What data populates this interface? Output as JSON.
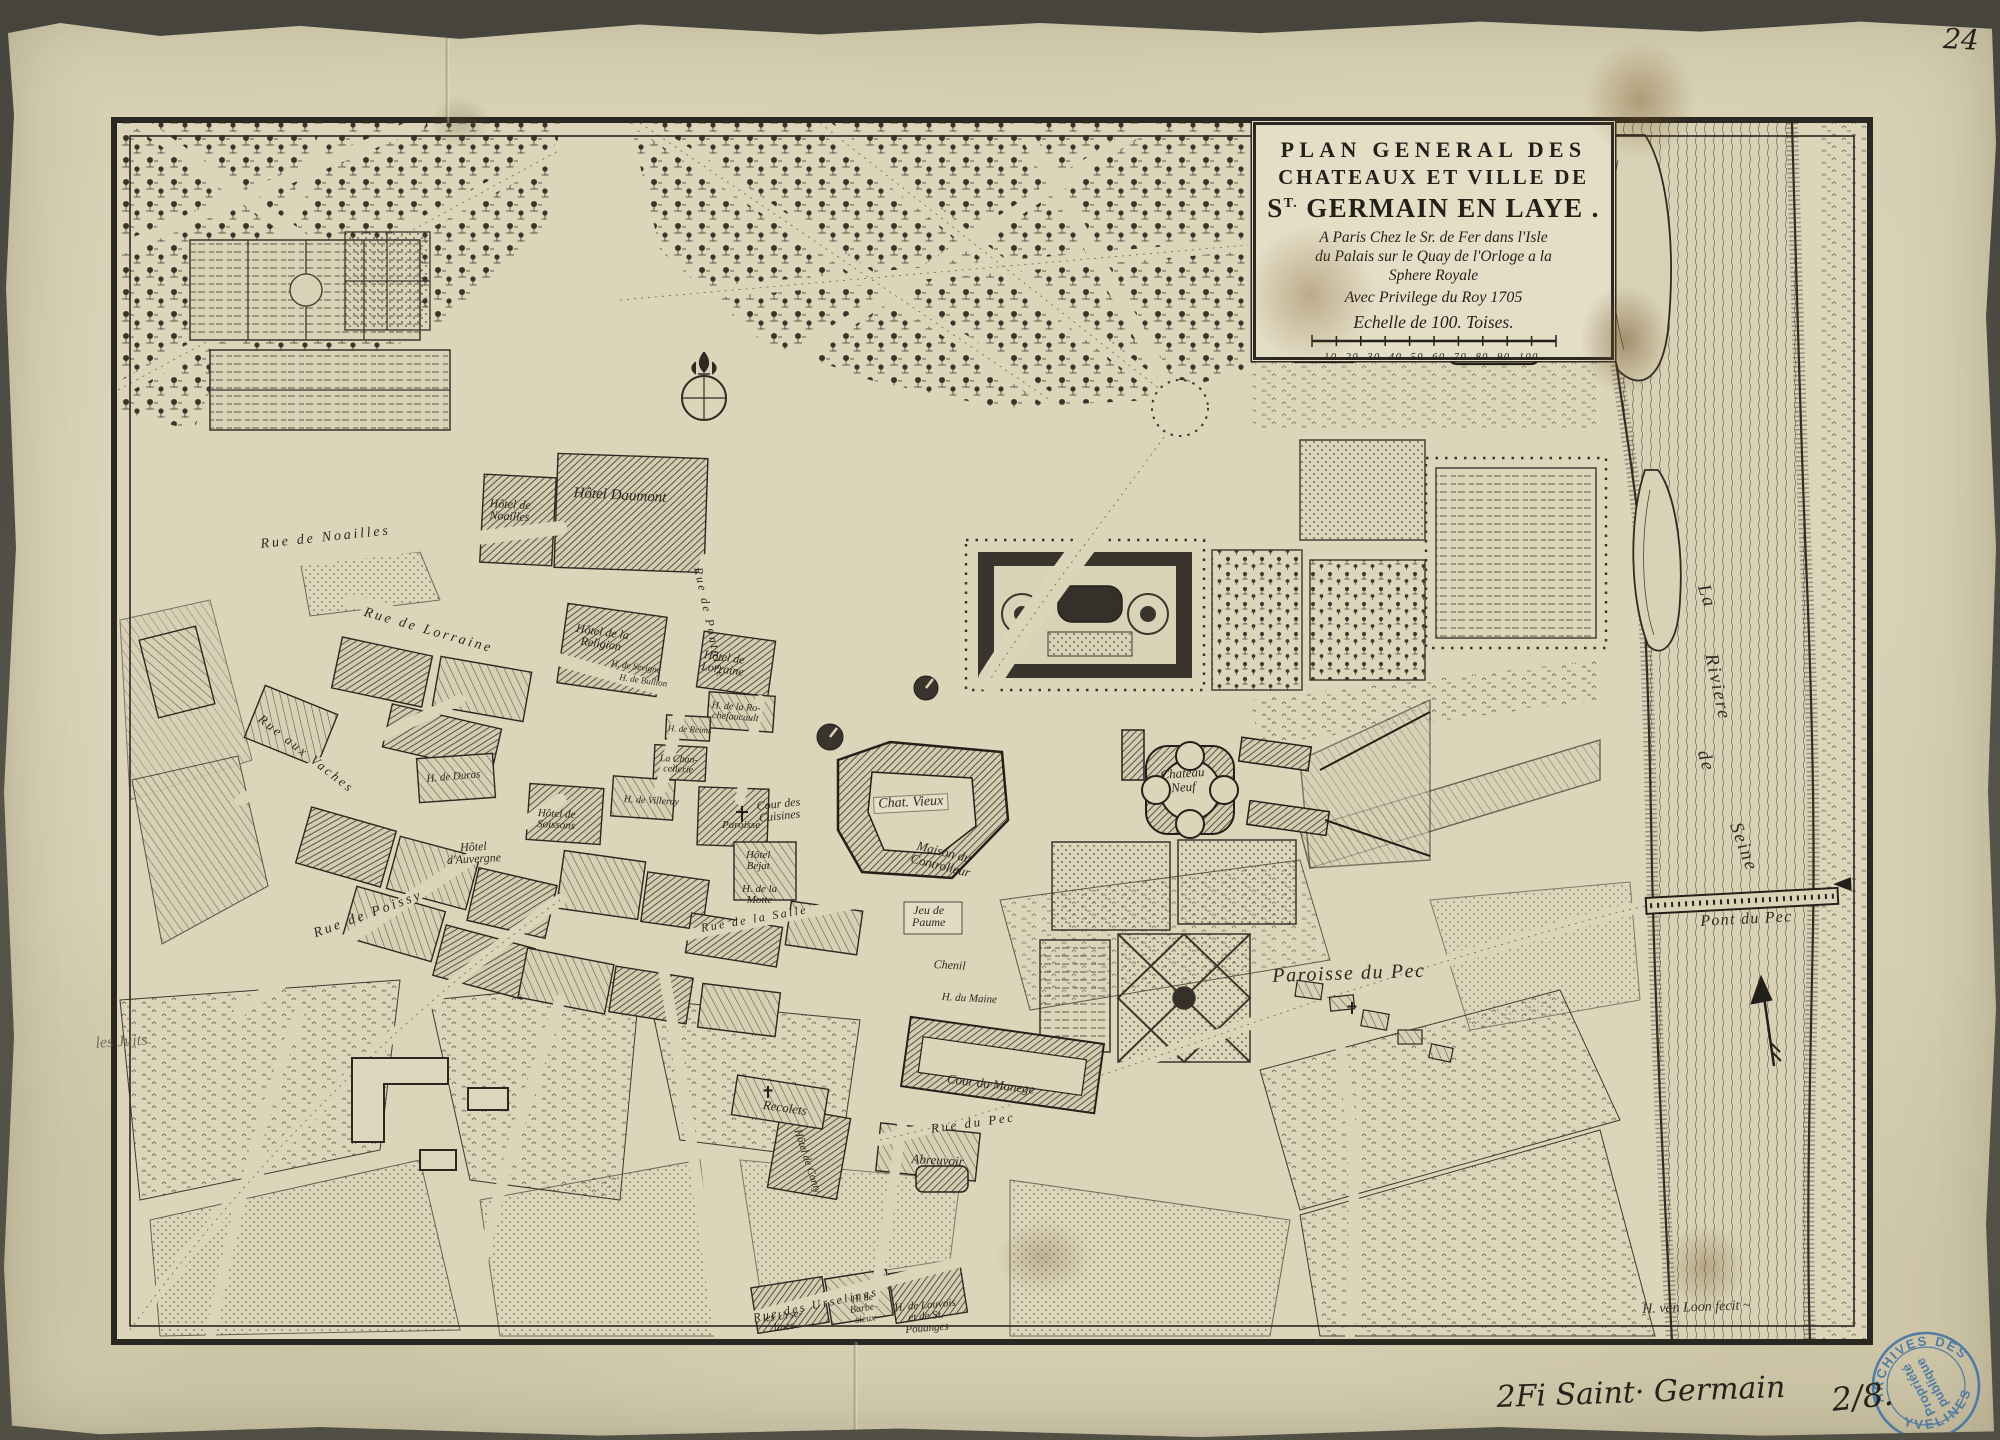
{
  "title": {
    "line1": "PLAN GENERAL DES",
    "line2": "CHATEAUX ET VILLE DE",
    "line3_pre": "S",
    "line3_sup": "T.",
    "line3_post": " GERMAIN EN LAYE .",
    "addr1": "A Paris Chez le Sr. de Fer dans l'Isle",
    "addr2": "du Palais sur le Quay de l'Orloge a la",
    "addr3": "Sphere Royale",
    "addr4": "Avec Privilege du Roy 1705",
    "scale_label": "Echelle de 100. Toises.",
    "scale_numbers": "10. 20. 30. 40. 50. 60. 70. 80. 90. 100."
  },
  "annotations": {
    "page_number": "24",
    "inventory": "2Fi Saint· Germain",
    "inventory_number": "2/8.",
    "signature": "H. van Loon fecit ~"
  },
  "stamp": {
    "arc_top": "ARCHIVES DES",
    "arc_bottom": "YVELINES",
    "center_line1": "Propriété",
    "center_line2": "publique",
    "color": "#3e6fa3"
  },
  "map": {
    "colors": {
      "paper": "#d8d1b5",
      "ink": "#2b2721",
      "stamp_blue": "#3e6fa3"
    },
    "labels": [
      {
        "id": "rue-de-noailles",
        "text": "Rue de Noailles",
        "x": 260,
        "y": 538,
        "rot": -6,
        "fs": 14,
        "cls": "rd"
      },
      {
        "id": "rue-de-lorraine",
        "text": "Rue de Lorraine",
        "x": 366,
        "y": 606,
        "rot": 16,
        "fs": 14,
        "cls": "rd"
      },
      {
        "id": "rue-de-pontoise",
        "text": "Rue de Pontoise",
        "x": 704,
        "y": 566,
        "rot": 78,
        "fs": 12,
        "cls": "rd"
      },
      {
        "id": "rue-aux-vaches",
        "text": "Rue aux Vaches",
        "x": 264,
        "y": 712,
        "rot": 38,
        "fs": 13,
        "cls": "rd"
      },
      {
        "id": "rue-de-poissy",
        "text": "Rue de Poissy",
        "x": 312,
        "y": 928,
        "rot": -20,
        "fs": 14,
        "cls": "rd"
      },
      {
        "id": "rue-de-la-salle",
        "text": "Rue de la Salle",
        "x": 700,
        "y": 922,
        "rot": -10,
        "fs": 12,
        "cls": "rd"
      },
      {
        "id": "rue-du-pec",
        "text": "Rue du Pec",
        "x": 930,
        "y": 1122,
        "rot": -8,
        "fs": 13,
        "cls": "rd"
      },
      {
        "id": "rue-des-urselines",
        "text": "Rue des Urselines",
        "x": 752,
        "y": 1312,
        "rot": -12,
        "fs": 12,
        "cls": "rd"
      },
      {
        "id": "hotel-daumont",
        "text": "Hôtel Daumont",
        "x": 574,
        "y": 486,
        "rot": 3,
        "fs": 15,
        "cls": "ht"
      },
      {
        "id": "hotel-de-noailles",
        "text": "Hôtel de\nNoailles",
        "x": 490,
        "y": 497,
        "rot": 3,
        "fs": 12,
        "cls": "ht"
      },
      {
        "id": "hotel-de-la-religion",
        "text": "Hôtel de la\nReligion",
        "x": 577,
        "y": 622,
        "rot": 8,
        "fs": 12,
        "cls": "ht"
      },
      {
        "id": "h-de-sevigne",
        "text": "H. de Sevigné",
        "x": 612,
        "y": 659,
        "rot": 8,
        "fs": 9,
        "cls": "ht"
      },
      {
        "id": "h-de-bullion",
        "text": "H. de Bullion",
        "x": 620,
        "y": 673,
        "rot": 8,
        "fs": 9,
        "cls": "ht"
      },
      {
        "id": "hotel-de-lorraine",
        "text": "Hôtel de\nLorraine",
        "x": 704,
        "y": 648,
        "rot": 8,
        "fs": 12,
        "cls": "ht"
      },
      {
        "id": "h-de-la-rochefaucault",
        "text": "H. de la Ro-\nchefaucault",
        "x": 712,
        "y": 701,
        "rot": 4,
        "fs": 10,
        "cls": "ht"
      },
      {
        "id": "h-de-reims",
        "text": "H. de Reims",
        "x": 668,
        "y": 724,
        "rot": 3,
        "fs": 9,
        "cls": "ht"
      },
      {
        "id": "la-chancellerie",
        "text": "La Chan-\ncellerie",
        "x": 660,
        "y": 754,
        "rot": 3,
        "fs": 10,
        "cls": "ht"
      },
      {
        "id": "h-de-duras",
        "text": "H. de Duras",
        "x": 426,
        "y": 774,
        "rot": -5,
        "fs": 11,
        "cls": "ht"
      },
      {
        "id": "hotel-de-soissons",
        "text": "Hôtel de\nSoissons",
        "x": 538,
        "y": 808,
        "rot": 3,
        "fs": 11,
        "cls": "ht"
      },
      {
        "id": "h-de-villeroy",
        "text": "H. de Villeroy",
        "x": 624,
        "y": 795,
        "rot": 3,
        "fs": 10,
        "cls": "ht"
      },
      {
        "id": "hotel-dauvergne",
        "text": "Hôtel\nd'Auvergne",
        "x": 446,
        "y": 842,
        "rot": -3,
        "fs": 12,
        "cls": "ht"
      },
      {
        "id": "paroisse",
        "text": "Paroisse",
        "x": 722,
        "y": 820,
        "rot": 0,
        "fs": 11,
        "cls": "ht"
      },
      {
        "id": "hotel-bejat",
        "text": "Hôtel\nBejat",
        "x": 746,
        "y": 850,
        "rot": 0,
        "fs": 11,
        "cls": "ht"
      },
      {
        "id": "h-de-la-motte",
        "text": "H. de la\nMotte",
        "x": 742,
        "y": 884,
        "rot": 0,
        "fs": 11,
        "cls": "ht"
      },
      {
        "id": "maison-du-controlleur",
        "text": "Maison du\nControlleur",
        "x": 916,
        "y": 838,
        "rot": 14,
        "fs": 13,
        "cls": "ht"
      },
      {
        "id": "chat-vieux",
        "text": "Chat. Vieux",
        "x": 874,
        "y": 798,
        "rot": -3,
        "fs": 14,
        "cls": "ht pl"
      },
      {
        "id": "cour-des-cuisines",
        "text": "Cour des\nCuisines",
        "x": 756,
        "y": 800,
        "rot": -6,
        "fs": 12,
        "cls": "ht"
      },
      {
        "id": "chateau-neuf",
        "text": "Chateau\nNeuf",
        "x": 1160,
        "y": 768,
        "rot": -4,
        "fs": 13,
        "cls": "ht"
      },
      {
        "id": "jeu-de-paume",
        "text": "Jeu de\nPaume",
        "x": 912,
        "y": 904,
        "rot": 0,
        "fs": 12,
        "cls": "ht"
      },
      {
        "id": "chenil",
        "text": "Chenil",
        "x": 934,
        "y": 958,
        "rot": 3,
        "fs": 12,
        "cls": "ht"
      },
      {
        "id": "h-du-maine",
        "text": "H. du Maine",
        "x": 942,
        "y": 992,
        "rot": 3,
        "fs": 11,
        "cls": "ht"
      },
      {
        "id": "cour-du-manege",
        "text": "Cour du Manege",
        "x": 948,
        "y": 1072,
        "rot": 7,
        "fs": 13,
        "cls": "ht"
      },
      {
        "id": "recolets",
        "text": "Recolets",
        "x": 764,
        "y": 1098,
        "rot": 8,
        "fs": 13,
        "cls": "ht"
      },
      {
        "id": "abreuvoir",
        "text": "Abreuvoir",
        "x": 912,
        "y": 1152,
        "rot": 3,
        "fs": 13,
        "cls": "ht"
      },
      {
        "id": "hotel-de-conty",
        "text": "Hôtel de Conty",
        "x": 802,
        "y": 1128,
        "rot": 72,
        "fs": 11,
        "cls": "ht"
      },
      {
        "id": "les-urselines",
        "text": "les Urse-\nlines",
        "x": 762,
        "y": 1314,
        "rot": -8,
        "fs": 11,
        "cls": "ht"
      },
      {
        "id": "h-de-barbesieux",
        "text": "H. de\nBarbe-\nsieux",
        "x": 848,
        "y": 1296,
        "rot": -8,
        "fs": 10,
        "cls": "ht"
      },
      {
        "id": "h-de-louvois",
        "text": "H. de Louvois\net de St.\nPouanges",
        "x": 894,
        "y": 1303,
        "rot": -5,
        "fs": 11,
        "cls": "ht"
      },
      {
        "id": "paroisse-du-pec",
        "text": "Paroisse  du Pec",
        "x": 1272,
        "y": 966,
        "rot": -2,
        "fs": 20,
        "cls": "big"
      },
      {
        "id": "pont-du-pec",
        "text": "Pont du Pec",
        "x": 1700,
        "y": 914,
        "rot": -3,
        "fs": 16,
        "cls": "big"
      },
      {
        "id": "riviere-word-la",
        "text": "La",
        "x": 1712,
        "y": 582,
        "rot": 72,
        "fs": 19,
        "cls": "riv"
      },
      {
        "id": "riviere-word-riviere",
        "text": "Riviere",
        "x": 1720,
        "y": 652,
        "rot": 78,
        "fs": 19,
        "cls": "riv"
      },
      {
        "id": "riviere-word-de",
        "text": "de",
        "x": 1712,
        "y": 748,
        "rot": 74,
        "fs": 19,
        "cls": "riv"
      },
      {
        "id": "riviere-word-seine",
        "text": "Seine",
        "x": 1744,
        "y": 820,
        "rot": 70,
        "fs": 19,
        "cls": "riv"
      },
      {
        "id": "les-juits",
        "text": "les Juits",
        "x": 95,
        "y": 1036,
        "rot": -4,
        "fs": 16,
        "cls": "pencil"
      },
      {
        "id": "engraver-signature",
        "text": "H. van Loon fecit ~",
        "x": 1642,
        "y": 1303,
        "rot": -2,
        "fs": 14,
        "cls": "scr"
      },
      {
        "id": "handwritten-inventory",
        "text": "2Fi Saint· Germain",
        "x": 1496,
        "y": 1382,
        "rot": -2,
        "fs": 30,
        "cls": "ink"
      },
      {
        "id": "handwritten-number",
        "text": "2/8.",
        "x": 1830,
        "y": 1384,
        "rot": -6,
        "fs": 32,
        "cls": "ink"
      },
      {
        "id": "handwritten-page-number",
        "text": "24",
        "x": 1944,
        "y": 24,
        "rot": 3,
        "fs": 28,
        "cls": "ink"
      }
    ]
  }
}
